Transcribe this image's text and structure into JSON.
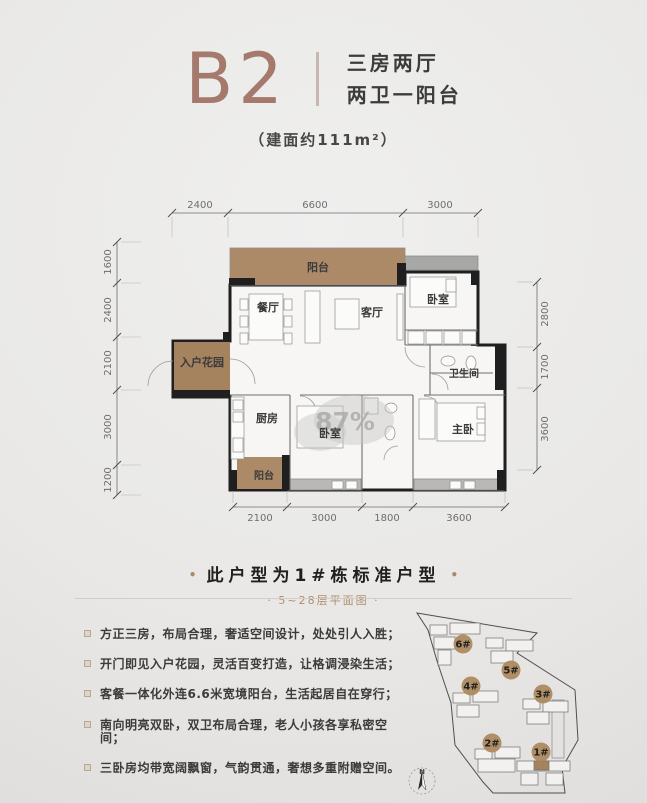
{
  "header": {
    "plan_code": "B2",
    "subtitle1": "三房两厅",
    "subtitle2": "两卫一阳台",
    "area_note": "（建面约111m²）",
    "accent": "#a5796c"
  },
  "caption": {
    "side_dot": "•",
    "main": "此户型为1#栋标准户型",
    "sub_display": "· 5~28层平面图 ·"
  },
  "features": {
    "items": [
      "方正三房，布局合理，奢适空间设计，处处引人入胜；",
      "开门即见入户花园，灵活百变打造，让格调浸染生活；",
      "客餐一体化外连6.6米宽境阳台，生活起居自在穿行；",
      "南向明亮双卧，双卫布局合理，老人小孩各享私密空间；",
      "三卧房均带宽阔飘窗，气韵贯通，奢想多重附赠空间。"
    ]
  },
  "floor_plan": {
    "colors": {
      "interior": "#f7f6f4",
      "wall": "#1f1f1f",
      "line": "#7d7d7d",
      "dim": "#6e6e6e",
      "balcony": "#ac8a68",
      "garden": "#a5835e",
      "ledge": "#a7a7a5",
      "bay": "#b9b8b6"
    },
    "outline": "M 405,272 L 478,272 L 478,345 L 505,345 L 505,490 L 230,490 L 230,397 L 173,397 L 173,341 L 230,341 L 230,285 L 405,285 Z",
    "areas": [
      {
        "name": "balcony-top",
        "x": 230,
        "y": 248,
        "w": 175,
        "h": 37,
        "fill": "balcony",
        "stroke": true
      },
      {
        "name": "ac-ledge",
        "x": 405,
        "y": 256,
        "w": 73,
        "h": 14,
        "fill": "ledge",
        "stroke": true
      },
      {
        "name": "entry-garden",
        "x": 174,
        "y": 342,
        "w": 56,
        "h": 55,
        "fill": "garden"
      },
      {
        "name": "balcony-small",
        "x": 237,
        "y": 457,
        "w": 46,
        "h": 32,
        "fill": "balcony"
      },
      {
        "name": "bay-window-left",
        "x": 288,
        "y": 479,
        "w": 73,
        "h": 11,
        "fill": "bay",
        "stroke": true
      },
      {
        "name": "bay-window-right",
        "x": 414,
        "y": 479,
        "w": 90,
        "h": 11,
        "fill": "bay",
        "stroke": true
      }
    ],
    "black_blocks": [
      [
        229,
        278,
        26,
        7
      ],
      [
        397,
        263,
        9,
        22
      ],
      [
        471,
        272,
        8,
        13
      ],
      [
        471,
        332,
        8,
        14
      ],
      [
        495,
        345,
        10,
        45
      ],
      [
        497,
        470,
        8,
        20
      ],
      [
        229,
        470,
        8,
        20
      ],
      [
        173,
        390,
        57,
        7
      ],
      [
        282,
        455,
        8,
        35
      ],
      [
        223,
        332,
        8,
        10
      ]
    ],
    "partitions": [
      [
        405,
        285,
        405,
        345
      ],
      [
        405,
        330,
        478,
        330
      ],
      [
        405,
        345,
        478,
        345
      ],
      [
        430,
        345,
        430,
        395
      ],
      [
        230,
        395,
        290,
        395
      ],
      [
        300,
        395,
        362,
        395
      ],
      [
        362,
        395,
        413,
        395
      ],
      [
        424,
        395,
        505,
        395
      ],
      [
        290,
        395,
        290,
        490
      ],
      [
        362,
        395,
        362,
        490
      ],
      [
        413,
        395,
        413,
        490
      ],
      [
        430,
        373,
        493,
        373
      ]
    ],
    "doors": [
      "M 148,386 A 25 25 0 0 1 173,361",
      "M 255,384 A 25 25 0 0 0 230,359",
      "M 405,347 A 20 20 0 0 0 425,367",
      "M 448,390 A 16 16 0 0 0 432,374",
      "M 424,396 A 16 16 0 0 1 440,412",
      "M 300,396 A 16 16 0 0 1 316,412",
      "M 398,446 A 14 14 0 0 0 384,460"
    ],
    "furniture": [
      [
        249,
        294,
        34,
        46
      ],
      [
        240,
        299,
        8,
        11
      ],
      [
        240,
        316,
        8,
        11
      ],
      [
        240,
        333,
        8,
        11
      ],
      [
        284,
        299,
        8,
        11
      ],
      [
        284,
        316,
        8,
        11
      ],
      [
        284,
        333,
        8,
        11
      ],
      [
        305,
        291,
        15,
        52
      ],
      [
        335,
        299,
        24,
        30
      ],
      [
        397,
        294,
        6,
        46
      ],
      [
        410,
        277,
        46,
        30
      ],
      [
        446,
        279,
        10,
        13
      ],
      [
        408,
        331,
        16,
        13
      ],
      [
        426,
        331,
        16,
        13
      ],
      [
        444,
        331,
        16,
        13
      ],
      [
        462,
        331,
        14,
        13
      ],
      [
        419,
        399,
        16,
        40
      ],
      [
        437,
        403,
        48,
        38
      ],
      [
        477,
        407,
        8,
        12
      ],
      [
        477,
        423,
        8,
        12
      ],
      [
        297,
        406,
        46,
        42
      ],
      [
        231,
        397,
        13,
        62
      ],
      [
        233,
        400,
        10,
        10
      ],
      [
        233,
        412,
        10,
        10
      ],
      [
        233,
        438,
        10,
        14
      ],
      [
        364,
        398,
        14,
        16
      ],
      [
        332,
        481,
        11,
        8
      ],
      [
        346,
        481,
        11,
        8
      ],
      [
        450,
        481,
        11,
        8
      ],
      [
        464,
        481,
        11,
        8
      ]
    ],
    "fixtures": [
      [
        448,
        361,
        7,
        5
      ],
      [
        471,
        363,
        5,
        7
      ],
      [
        390,
        433,
        5,
        7
      ],
      [
        391,
        408,
        6,
        5
      ]
    ],
    "watermark": {
      "text": "87%",
      "x": 345,
      "y": 430
    },
    "room_labels": [
      {
        "t": "阳台",
        "x": 318,
        "y": 271
      },
      {
        "t": "餐厅",
        "x": 268,
        "y": 311
      },
      {
        "t": "客厅",
        "x": 372,
        "y": 316
      },
      {
        "t": "卧室",
        "x": 438,
        "y": 303
      },
      {
        "t": "入户花园",
        "x": 202,
        "y": 366
      },
      {
        "t": "卫生间",
        "x": 464,
        "y": 377,
        "s": 10
      },
      {
        "t": "厨房",
        "x": 267,
        "y": 422
      },
      {
        "t": "卧室",
        "x": 330,
        "y": 437
      },
      {
        "t": "阳台",
        "x": 264,
        "y": 479,
        "s": 10
      },
      {
        "t": "主卧",
        "x": 463,
        "y": 433
      }
    ],
    "dims": {
      "top": {
        "y": 213,
        "x1": 172,
        "x2": 478,
        "ticks": [
          172,
          228,
          403,
          478
        ],
        "labels": [
          {
            "t": "2400",
            "x": 200
          },
          {
            "t": "6600",
            "x": 315
          },
          {
            "t": "3000",
            "x": 440
          }
        ]
      },
      "bottom": {
        "y": 507,
        "x1": 233,
        "x2": 505,
        "ticks": [
          233,
          287,
          362,
          413,
          505
        ],
        "labels": [
          {
            "t": "2100",
            "x": 260
          },
          {
            "t": "3000",
            "x": 324
          },
          {
            "t": "1800",
            "x": 387
          },
          {
            "t": "3600",
            "x": 459
          }
        ]
      },
      "left": {
        "x": 117,
        "y1": 242,
        "y2": 495,
        "ticks": [
          242,
          283,
          337,
          390,
          465,
          495
        ],
        "labels": [
          {
            "t": "1600",
            "y": 262
          },
          {
            "t": "2400",
            "y": 310
          },
          {
            "t": "2100",
            "y": 363
          },
          {
            "t": "3000",
            "y": 427
          },
          {
            "t": "1200",
            "y": 480
          }
        ]
      },
      "right": {
        "x": 537,
        "y1": 282,
        "y2": 470,
        "ticks": [
          282,
          347,
          388,
          470
        ],
        "labels": [
          {
            "t": "2800",
            "y": 314
          },
          {
            "t": "1700",
            "y": 367
          },
          {
            "t": "3600",
            "y": 429
          }
        ]
      }
    }
  },
  "site_map": {
    "outline": "417,613 537,633 517,653 575,690 578,740 562,768 565,793 493,793 483,782 455,745 451,703 437,661 428,630",
    "podium": [
      [
        552,
        700,
        12,
        58
      ]
    ],
    "buildings": [
      {
        "label": "6#",
        "badge": [
          463,
          644
        ],
        "rects": [
          [
            430,
            625,
            17,
            10
          ],
          [
            450,
            623,
            30,
            11
          ],
          [
            434,
            637,
            21,
            12
          ],
          [
            438,
            650,
            13,
            15
          ]
        ]
      },
      {
        "label": "5#",
        "badge": [
          511,
          670
        ],
        "rects": [
          [
            486,
            638,
            17,
            10
          ],
          [
            506,
            640,
            27,
            11
          ],
          [
            491,
            651,
            22,
            12
          ]
        ]
      },
      {
        "label": "4#",
        "badge": [
          471,
          686
        ],
        "rects": [
          [
            453,
            693,
            17,
            10
          ],
          [
            473,
            691,
            25,
            11
          ],
          [
            457,
            705,
            22,
            12
          ]
        ]
      },
      {
        "label": "3#",
        "badge": [
          543,
          694
        ],
        "rects": [
          [
            523,
            699,
            17,
            10
          ],
          [
            543,
            701,
            25,
            11
          ],
          [
            527,
            712,
            22,
            12
          ]
        ]
      },
      {
        "label": "2#",
        "badge": [
          492,
          743
        ],
        "rects": [
          [
            475,
            749,
            17,
            10
          ],
          [
            495,
            747,
            25,
            11
          ],
          [
            478,
            759,
            37,
            13
          ]
        ]
      },
      {
        "label": "1#",
        "badge": [
          541,
          752
        ],
        "highlight": [
          534,
          761,
          15,
          9
        ],
        "rects": [
          [
            517,
            761,
            53,
            10
          ],
          [
            521,
            773,
            17,
            12
          ],
          [
            546,
            773,
            17,
            12
          ]
        ]
      }
    ],
    "compass": {
      "x": 422,
      "y": 781,
      "r": 13,
      "label": "N"
    }
  }
}
